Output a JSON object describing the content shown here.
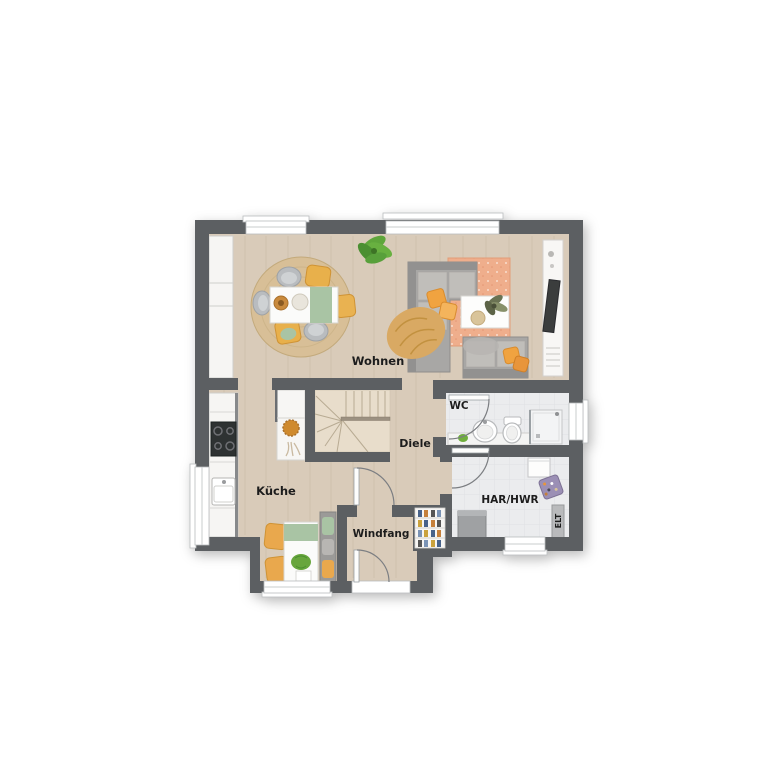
{
  "plan": {
    "rooms": {
      "wohnen": {
        "label": "Wohnen"
      },
      "kueche": {
        "label": "Küche"
      },
      "diele": {
        "label": "Diele"
      },
      "windfang": {
        "label": "Windfang"
      },
      "wc": {
        "label": "WC"
      },
      "har_hwr": {
        "label": "HAR/HWR"
      },
      "elt": {
        "label": "ELT"
      }
    },
    "colors": {
      "wall": "#5b5e62",
      "wood_floor": "#d9cbb9",
      "tile_floor": "#ebecee",
      "rug_salmon": "#efae8c",
      "rug_jute": "#d8bf97",
      "sofa_gray": "#a7a5a3",
      "accent_orange": "#f0a23c",
      "accent_green": "#a9c4a4",
      "plant_green": "#63a238",
      "white_furniture": "#fbfbfa",
      "stair_wood": "#e8ddcb",
      "background": "#ffffff",
      "label_text": "#1f1f1f"
    }
  }
}
